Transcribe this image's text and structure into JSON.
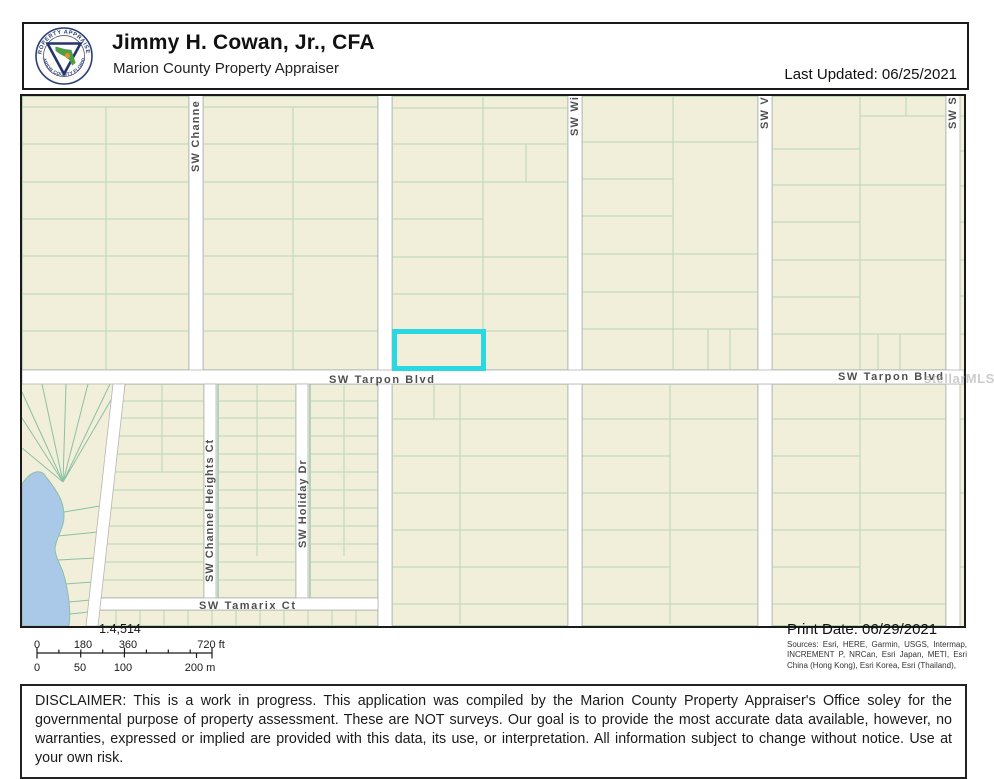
{
  "header": {
    "title": "Jimmy H. Cowan, Jr., CFA",
    "subtitle": "Marion County Property Appraiser",
    "last_updated": "Last Updated: 06/25/2021",
    "logo_ring_top": "PROPERTY APPRAISER",
    "logo_ring_bottom": "MARION COUNTY FLORIDA"
  },
  "map": {
    "labels": {
      "channel_top": "SW Channe",
      "wi": "SW Wi",
      "v": "SW V",
      "s": "SW S",
      "tarpon": "SW Tarpon Blvd",
      "tarpon_right": "SW Tarpon Blvd",
      "channel_heights": "SW Channel Heights Ct",
      "holiday": "SW Holiday Dr",
      "tamarix": "SW Tamarix Ct"
    },
    "watermark": "stellarMLS",
    "colors": {
      "parcel_fill": "#f1efd9",
      "parcel_line": "#8cc0a4",
      "parcel_line_light": "#b7d6bc",
      "road_fill": "#ffffff",
      "road_casing": "#b5b5b5",
      "water": "#aac9e9",
      "highlight": "#2ad8e2",
      "street_label": "#4f4f4f"
    }
  },
  "scale_bar": {
    "ratio": "1:4,514",
    "ft_labels": [
      "0",
      "180",
      "360",
      "720 ft"
    ],
    "m_labels": [
      "0",
      "50",
      "100",
      "200 m"
    ]
  },
  "print_info": {
    "print_date": "Print Date: 06/29/2021",
    "sources": "Sources: Esri, HERE, Garmin, USGS, Intermap, INCREMENT P, NRCan, Esri Japan, METI, Esri China (Hong Kong), Esri Korea, Esri (Thailand),"
  },
  "disclaimer": "DISCLAIMER: This is a work in progress. This application was compiled by the Marion County Property Appraiser's Office soley for the governmental purpose of property assessment. These are NOT surveys. Our goal is to provide the most accurate data available, however, no warranties, expressed or implied are provided with this data, its use, or interpretation. All information subject to change without notice. Use at your own risk."
}
